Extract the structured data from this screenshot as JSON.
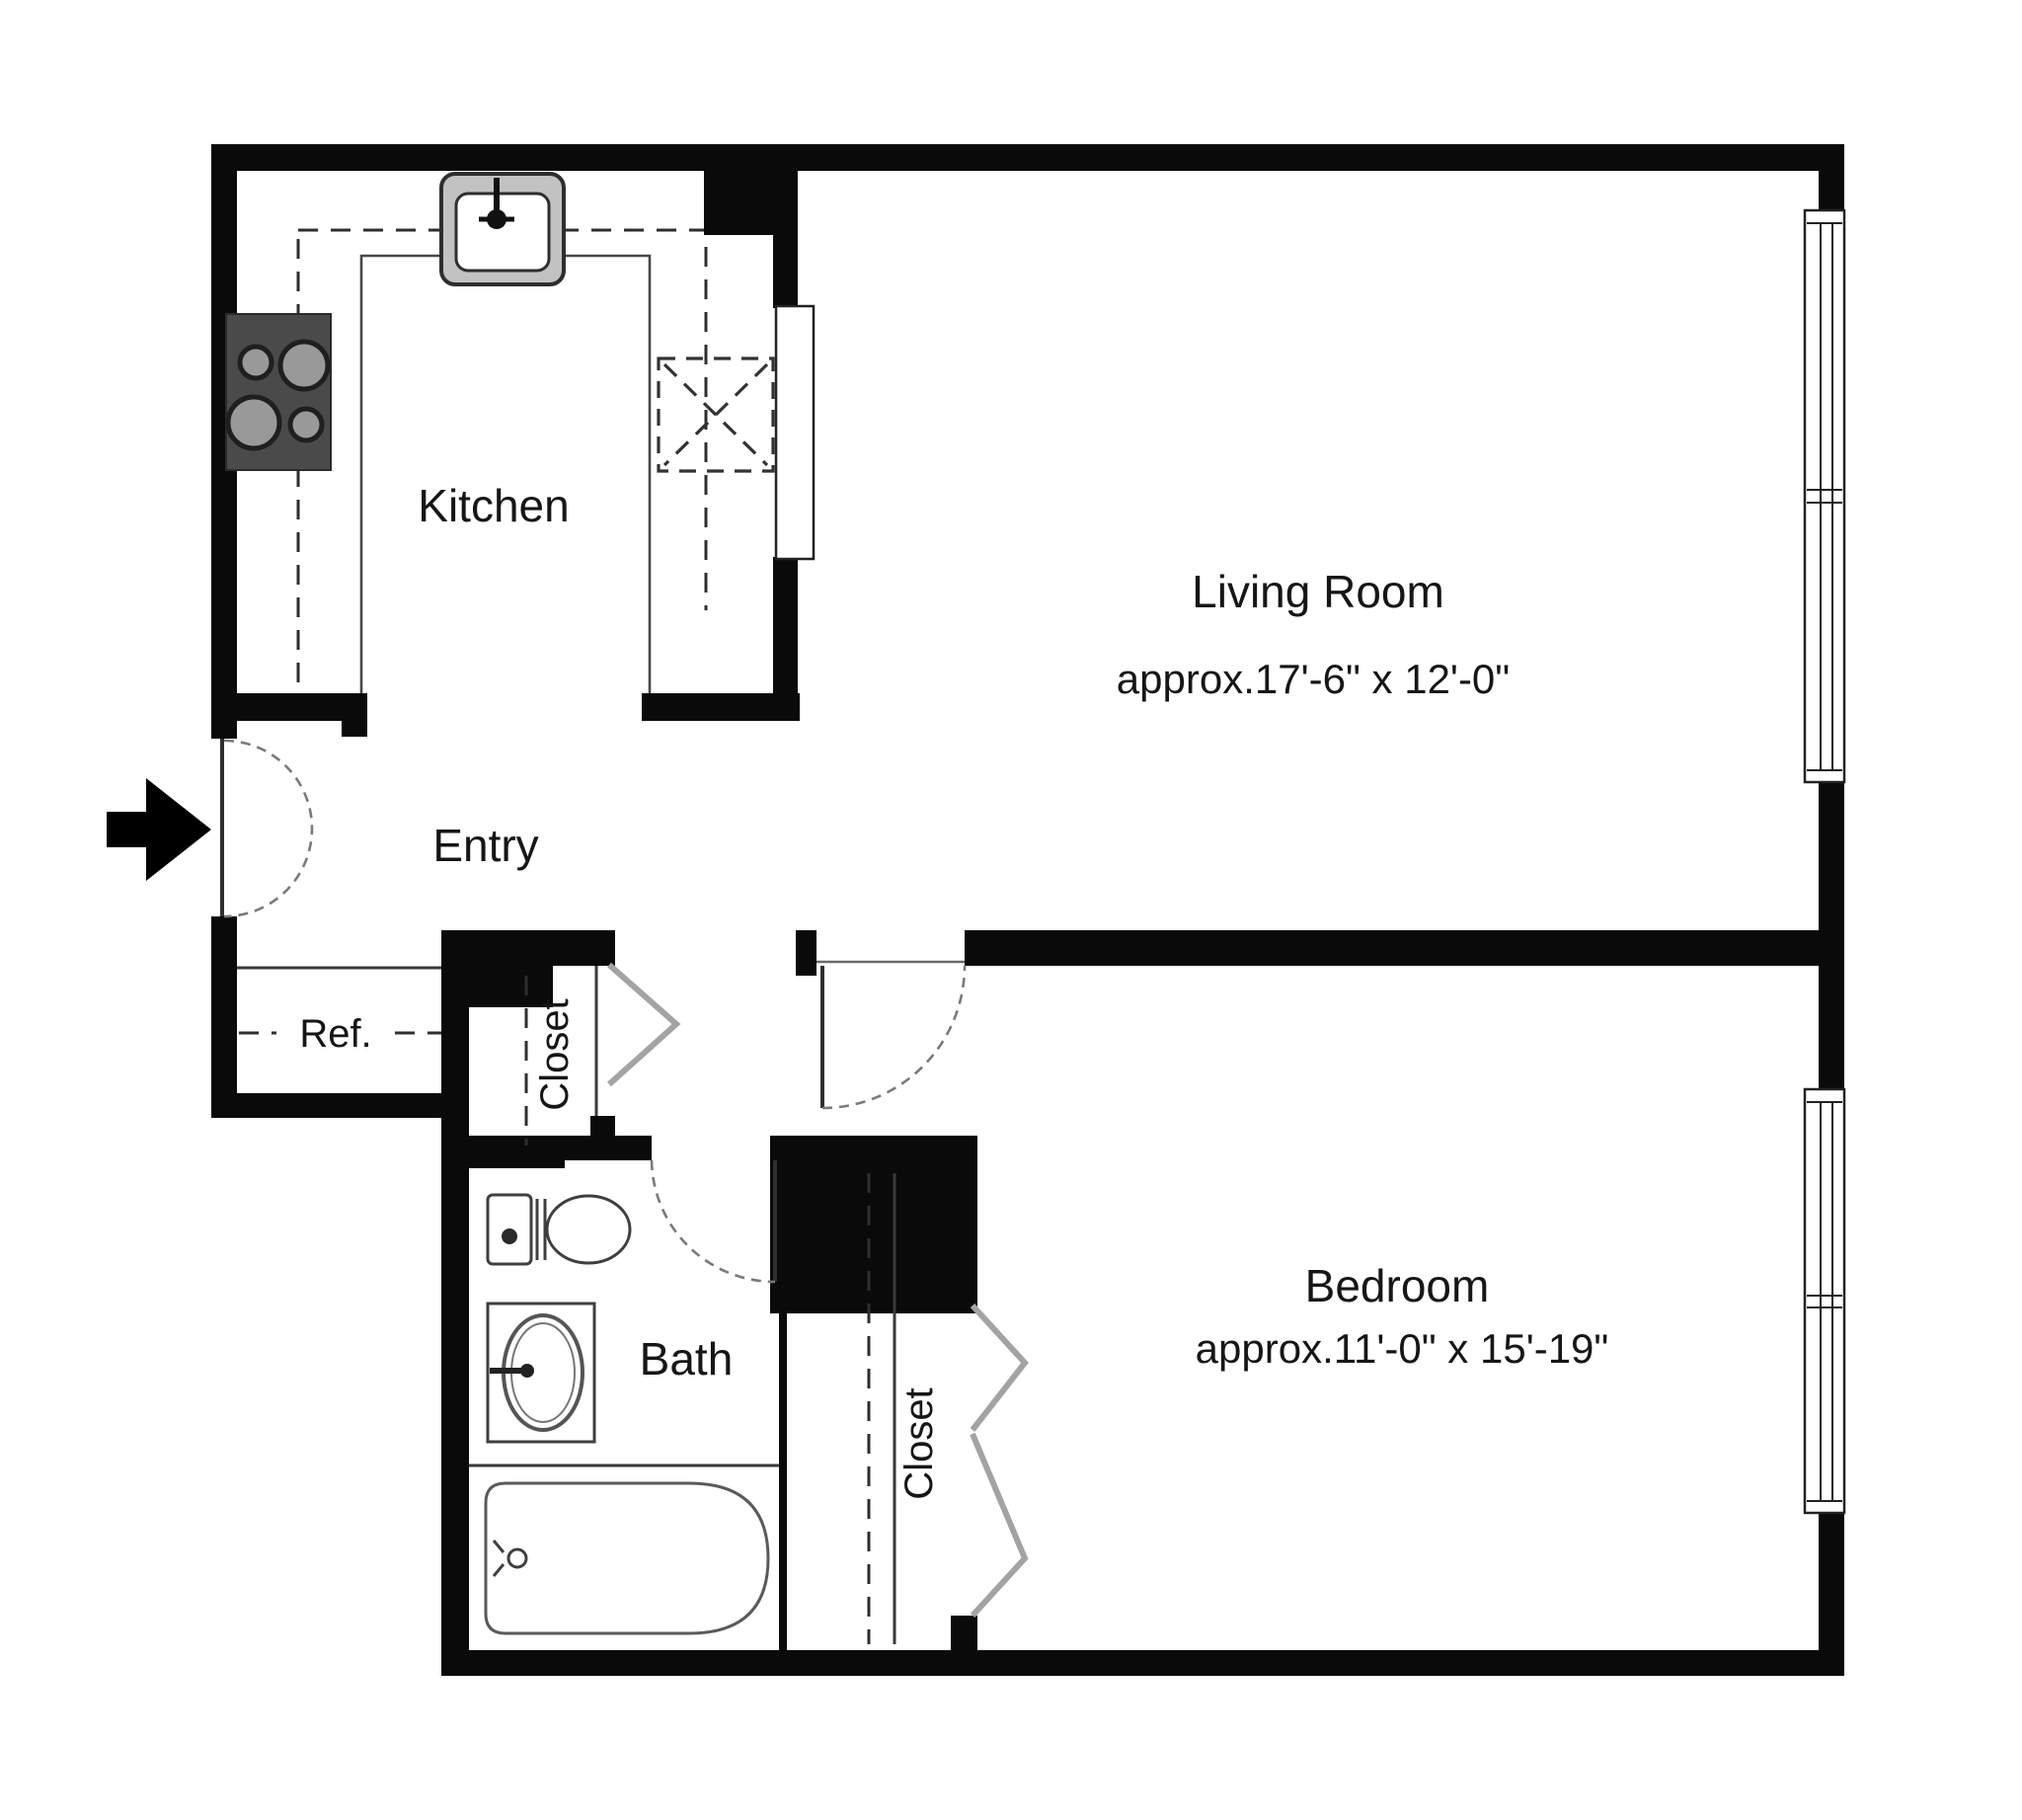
{
  "diagram": {
    "type": "apartment-floor-plan",
    "rooms": {
      "kitchen": {
        "label": "Kitchen"
      },
      "living_room": {
        "label": "Living Room",
        "dims": "approx.17'-6\" x 12'-0\""
      },
      "entry": {
        "label": "Entry"
      },
      "refrigerator": {
        "label": "Ref."
      },
      "entry_closet": {
        "label": "Closet"
      },
      "bath": {
        "label": "Bath"
      },
      "bedroom": {
        "label": "Bedroom",
        "dims": "approx.11'-0\" x 15'-19\""
      },
      "bedroom_closet": {
        "label": "Closet"
      }
    },
    "fixtures": [
      "kitchen-sink",
      "cooktop-4-burners",
      "dishwasher-dashed-box",
      "counter-dashed-lines",
      "pass-through",
      "entrance-arrow",
      "entry-door-swing",
      "bedroom-door-swing",
      "bath-door-swing",
      "toilet",
      "vanity-sink",
      "bathtub",
      "living-room-window",
      "bedroom-window",
      "bifold-closet-doors"
    ],
    "colors": {
      "background": "#ffffff",
      "wall": "#0a0a0a",
      "fixture_line": "#3f3f3f",
      "door_arc": "#7a7a7a",
      "bifold_door": "#a3a3a3",
      "cooktop_body": "#4a4a4a",
      "burner_fill": "#999999",
      "sink_frame": "#c2c2c2",
      "text": "#161616"
    }
  }
}
